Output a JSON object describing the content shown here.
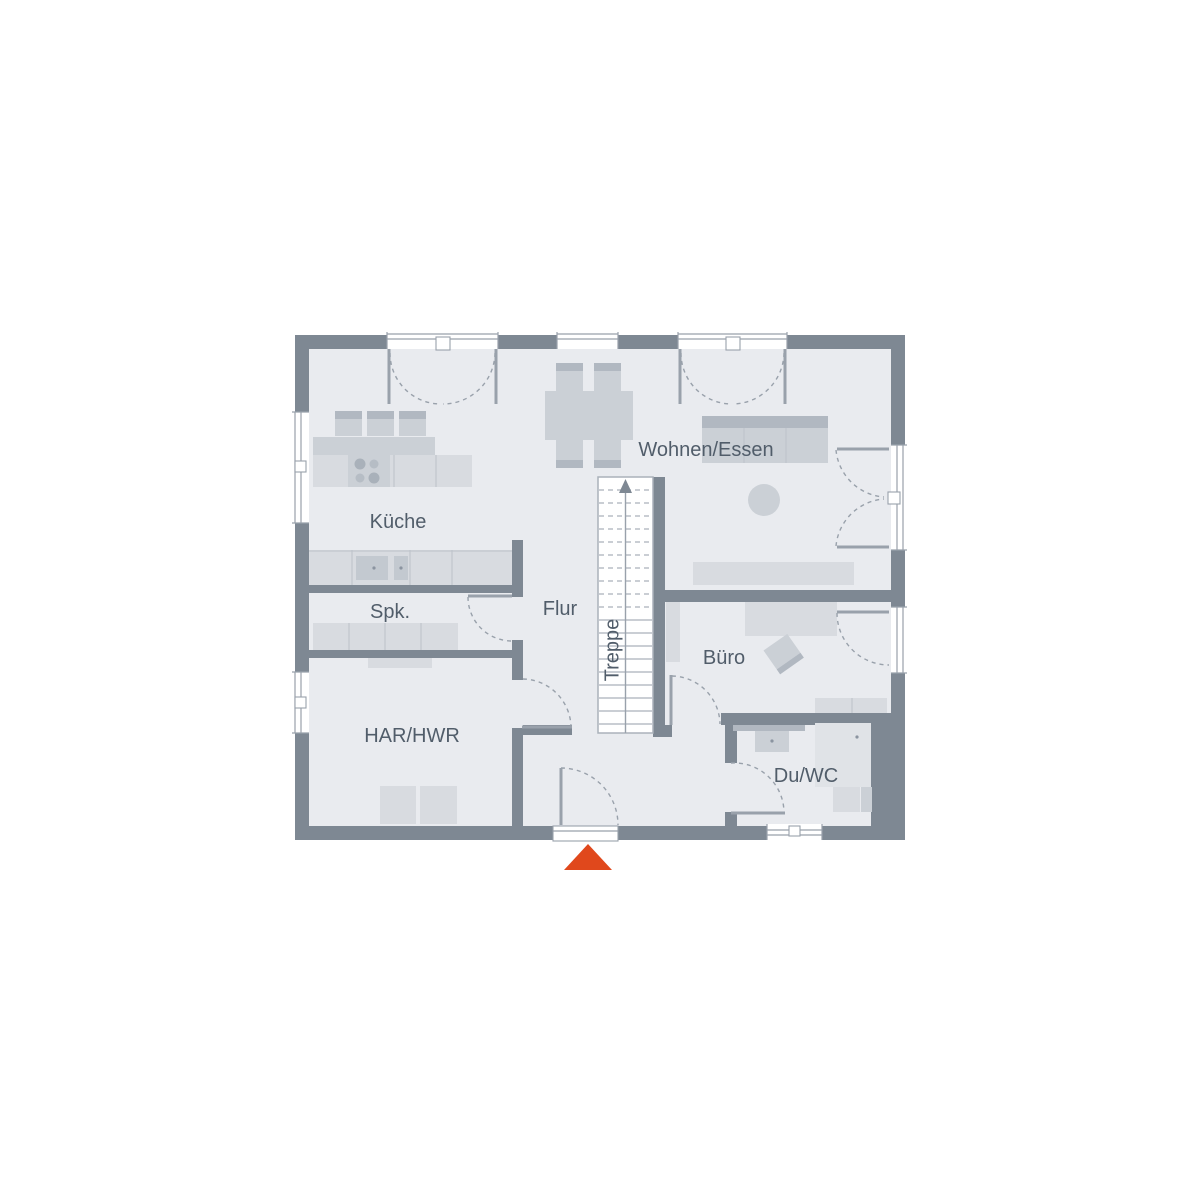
{
  "plan": {
    "rooms": {
      "kueche": "Küche",
      "wohnen_essen": "Wohnen/Essen",
      "spk": "Spk.",
      "flur": "Flur",
      "har_hwr": "HAR/HWR",
      "buero": "Büro",
      "du_wc": "Du/WC",
      "treppe": "Treppe"
    },
    "colors": {
      "wall": "#7e8893",
      "floor": "#e9ebef",
      "furniture_light": "#d8dbe0",
      "furniture_mid": "#cbd0d6",
      "furniture_dark": "#b1b8c1",
      "fixture": "#c3c9d0",
      "shower": "#e0e3e7",
      "line": "#99a1ab",
      "stair_line": "#aab1ba",
      "label": "#515d6a",
      "entrance_accent": "#e0481c",
      "background": "#ffffff"
    }
  }
}
